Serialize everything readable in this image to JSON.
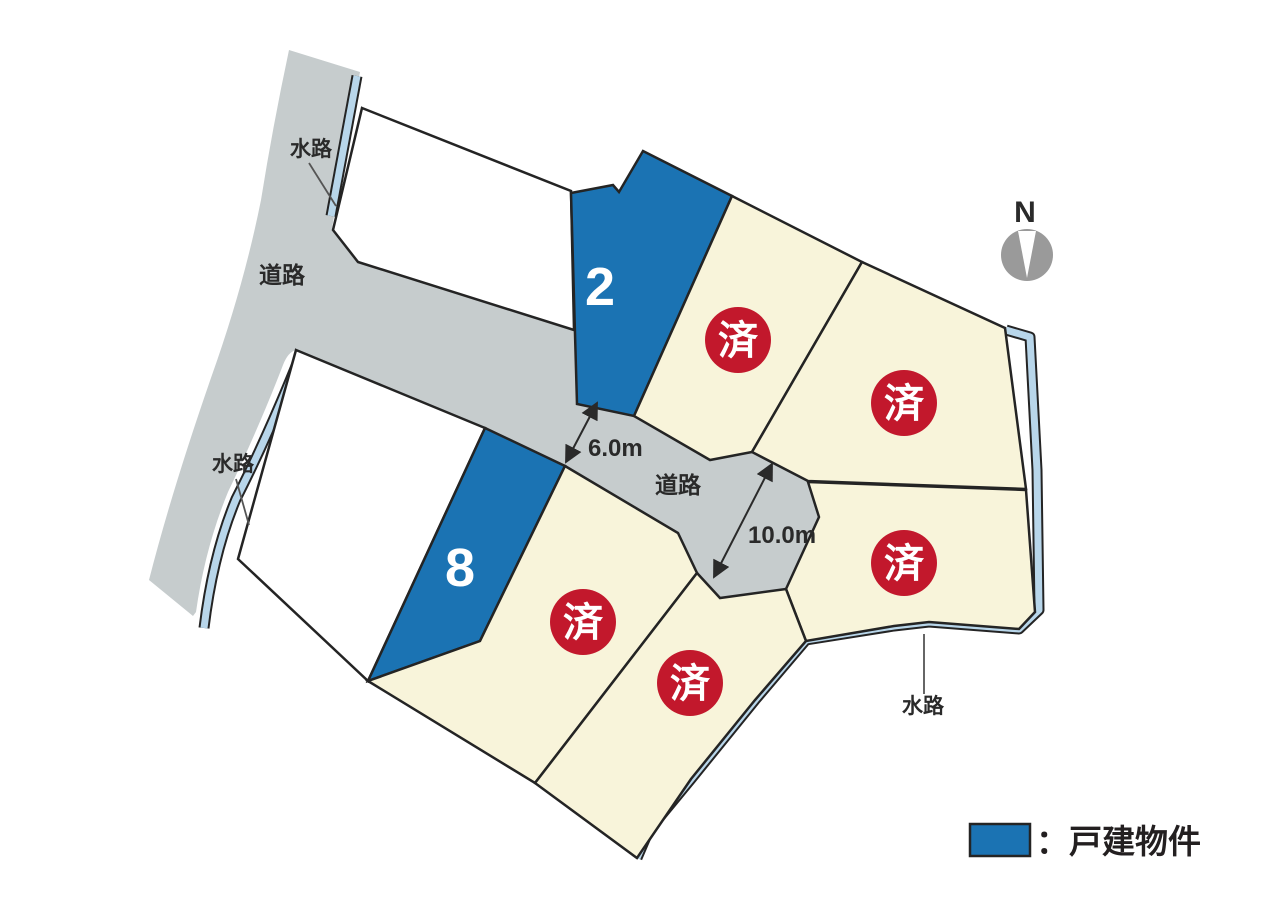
{
  "map": {
    "north_label": "N",
    "road_label": "道路",
    "waterway_label": "水路",
    "available_lots": [
      {
        "number": "2"
      },
      {
        "number": "8"
      }
    ],
    "sold_lots": [
      {
        "mark": "済"
      },
      {
        "mark": "済"
      },
      {
        "mark": "済"
      },
      {
        "mark": "済"
      },
      {
        "mark": "済"
      }
    ],
    "dimensions": [
      {
        "value": "6.0m"
      },
      {
        "value": "10.0m"
      }
    ],
    "colors": {
      "available_lot": "#1b73b3",
      "sold_lot_background": "#f8f4da",
      "sold_badge": "#c2182c",
      "road": "#c6cccd",
      "waterway": "#b8d6ea",
      "boundary": "#242424"
    }
  },
  "legend": {
    "swatch_color": "#1b73b3",
    "label": "：戸建物件"
  }
}
